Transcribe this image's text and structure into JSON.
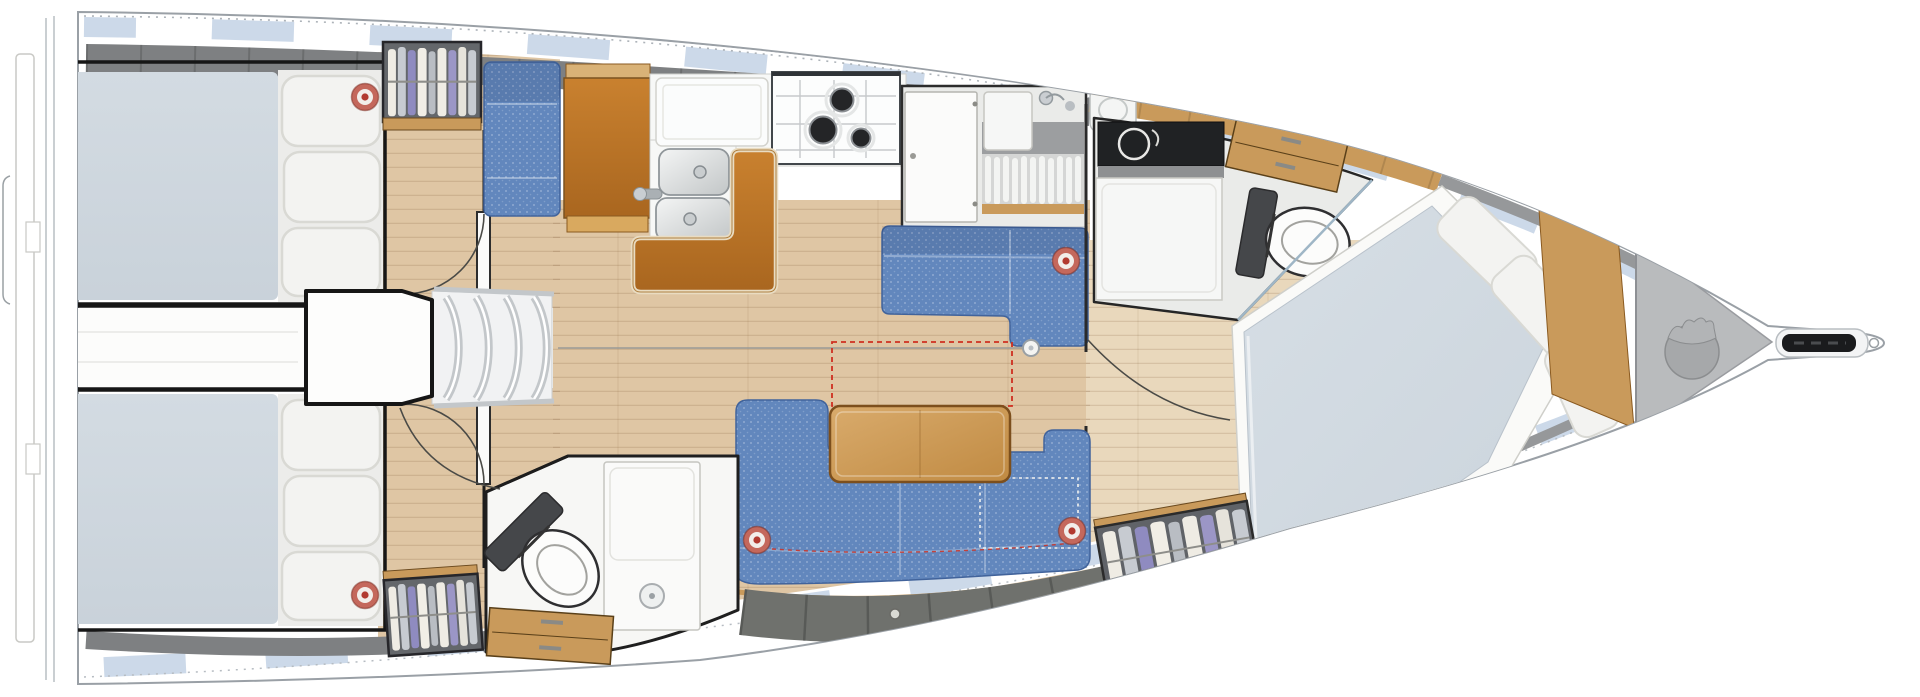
{
  "scene": {
    "type": "sailboat-interior-floor-plan",
    "view": "top-down",
    "orientation": {
      "bow": "right",
      "stern": "left"
    },
    "visible_text": ""
  },
  "palette": {
    "hull_outline": "#9aa0a6",
    "window_blue": "#ccd9e9",
    "wall_gray": "#7e8082",
    "locker_gray": "#6f716d",
    "floor_wood": "#dfc6a4",
    "floor_wood_light": "#e9d8bc",
    "cabinet_wood": "#c99a5b",
    "mattress": "#c9d2da",
    "mattress_fwd": "#ccd5dd",
    "cushion_white": "#f3f3f1",
    "cushion_shadow": "#d9d9d4",
    "upholstery_blue": "#6287bd",
    "upholstery_blue_dark": "#41639b",
    "leather_orange": "#c9812f",
    "leather_orange_dark": "#a9661f",
    "leather_trim": "#e9dcc2",
    "table_wood": "#d9ab6c",
    "table_wood_dark": "#7c4f1d",
    "fixture_white": "#f7f8f7",
    "steel": "#c3c7ca",
    "black_wall": "#161616",
    "counter_black": "#202224",
    "marker_ring": "#c4685c",
    "marker_center": "#b23a30",
    "dashed_red": "#cf2f20",
    "bag_gray": "#a6a8aa",
    "head_floor": "#eaebe9"
  },
  "inventory": {
    "rooms": [
      {
        "id": "aft-cabin-port",
        "furniture": [
          "double-berth",
          "pillows",
          "hanging-locker",
          "door"
        ]
      },
      {
        "id": "aft-cabin-starboard",
        "furniture": [
          "double-berth",
          "pillows",
          "hanging-locker",
          "door"
        ]
      },
      {
        "id": "companionway",
        "furniture": [
          "engine-box",
          "steps"
        ]
      },
      {
        "id": "nav-station",
        "furniture": [
          "seat",
          "chart-table"
        ]
      },
      {
        "id": "galley",
        "furniture": [
          "fridge-counter",
          "double-sink",
          "faucet",
          "three-burner-stove",
          "bench-seat"
        ]
      },
      {
        "id": "shower-room",
        "furniture": [
          "door",
          "sink",
          "shower-grating",
          "counter"
        ]
      },
      {
        "id": "salon",
        "furniture": [
          "port-settee",
          "folding-table",
          "l-shaped-sofa",
          "mast-post",
          "storage-lockers"
        ]
      },
      {
        "id": "aft-head",
        "furniture": [
          "toilet",
          "vanity-sink",
          "drawers"
        ]
      },
      {
        "id": "forward-head",
        "furniture": [
          "counter-sink",
          "vanity",
          "drawers",
          "toilet",
          "shower-partition"
        ]
      },
      {
        "id": "forward-cabin",
        "furniture": [
          "angled-double-berth",
          "pillows",
          "hanging-locker",
          "shelving"
        ]
      },
      {
        "id": "bow",
        "furniture": [
          "anchor-locker",
          "sail-bag",
          "bow-roller"
        ]
      }
    ],
    "annotations": [
      "red-dashed-option-rectangle",
      "white-dotted-berth-outline",
      "red-ring-markers"
    ]
  },
  "markers": {
    "shape": "red-ring",
    "positions": [
      {
        "x": 365,
        "y": 97
      },
      {
        "x": 1066,
        "y": 261
      },
      {
        "x": 757,
        "y": 540
      },
      {
        "x": 1072,
        "y": 531
      },
      {
        "x": 365,
        "y": 595
      }
    ]
  }
}
